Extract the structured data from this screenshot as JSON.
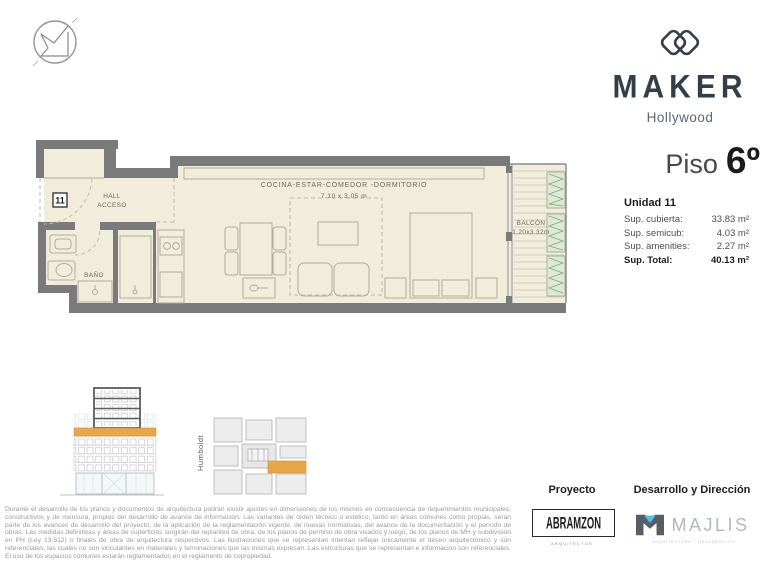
{
  "brand": {
    "name": "MAKER",
    "location": "Hollywood"
  },
  "floor": {
    "label": "Piso",
    "number": "6º"
  },
  "unit": {
    "title": "Unidad 11",
    "rows": [
      {
        "label": "Sup. cubierta:",
        "value": "33.83 m²"
      },
      {
        "label": "Sup. semicub:",
        "value": "4.03 m²"
      },
      {
        "label": "Sup. amenities:",
        "value": "2.27 m²"
      }
    ],
    "total": {
      "label": "Sup. Total:",
      "value": "40.13 m²"
    }
  },
  "plan": {
    "unit_number": "11",
    "hall_line1": "HALL",
    "hall_line2": "ACCESO",
    "bath": "BAÑO",
    "room_label": "COCINA-ESTAR-COMEDOR -DORMITORIO",
    "room_dims": "7.10 x 3.05 m",
    "balcony_label": "BALCÓN",
    "balcony_dims": "1.20x3.32m"
  },
  "key_plan": {
    "street": "Humboldt"
  },
  "disclaimer": "Durante el desarrollo de los planos y documentos de arquitectura podrán existir ajustes en dimensiones de los mismos en consecuencia de requerimientos municipales, constructivos y de mensura, propios del desarrollo de avance de información. Las variantes de orden técnico o estético, tanto en áreas comunes como propias, serán parte de los avances de desarrollo del proyecto, de la aplicación de la reglamentación vigente, de nuevas normativas, del avance de la documentación y el período de obras. Las medidas definitivas y áreas de superficies surgirán del replanteo de obra, de los planos de permiso de obra visados y luego, de los planos de MH y subdivisión en PH (Ley 13.512) o finales de obra de arquitectura respectivos. Las ilustraciones que se representan intentan reflejar únicamente el deseo arquitectónico y son referenciales, las cuales no son vinculantes en materiales y terminaciones que las mismas expresan. Las estructuras que se representan e información son referenciales. El uso de los espacios comunes estarán reglamentados en el reglamento de copropiedad.",
  "credits": {
    "project": {
      "heading": "Proyecto",
      "logo": "ABRAMZON",
      "sub": "ARQUITECTOS"
    },
    "development": {
      "heading": "Desarrollo y Dirección",
      "logo": "MAJLIS",
      "sub": "ARQUITECTURA + DESARROLLOS"
    }
  },
  "colors": {
    "accent_orange": "#E8A64B",
    "brand_navy": "#333E48",
    "wall_gray": "#7A7A7A",
    "floor_cream": "#F2ECDC",
    "plant_green": "#7FA878",
    "majlis_cyan": "#4FC4DE"
  }
}
